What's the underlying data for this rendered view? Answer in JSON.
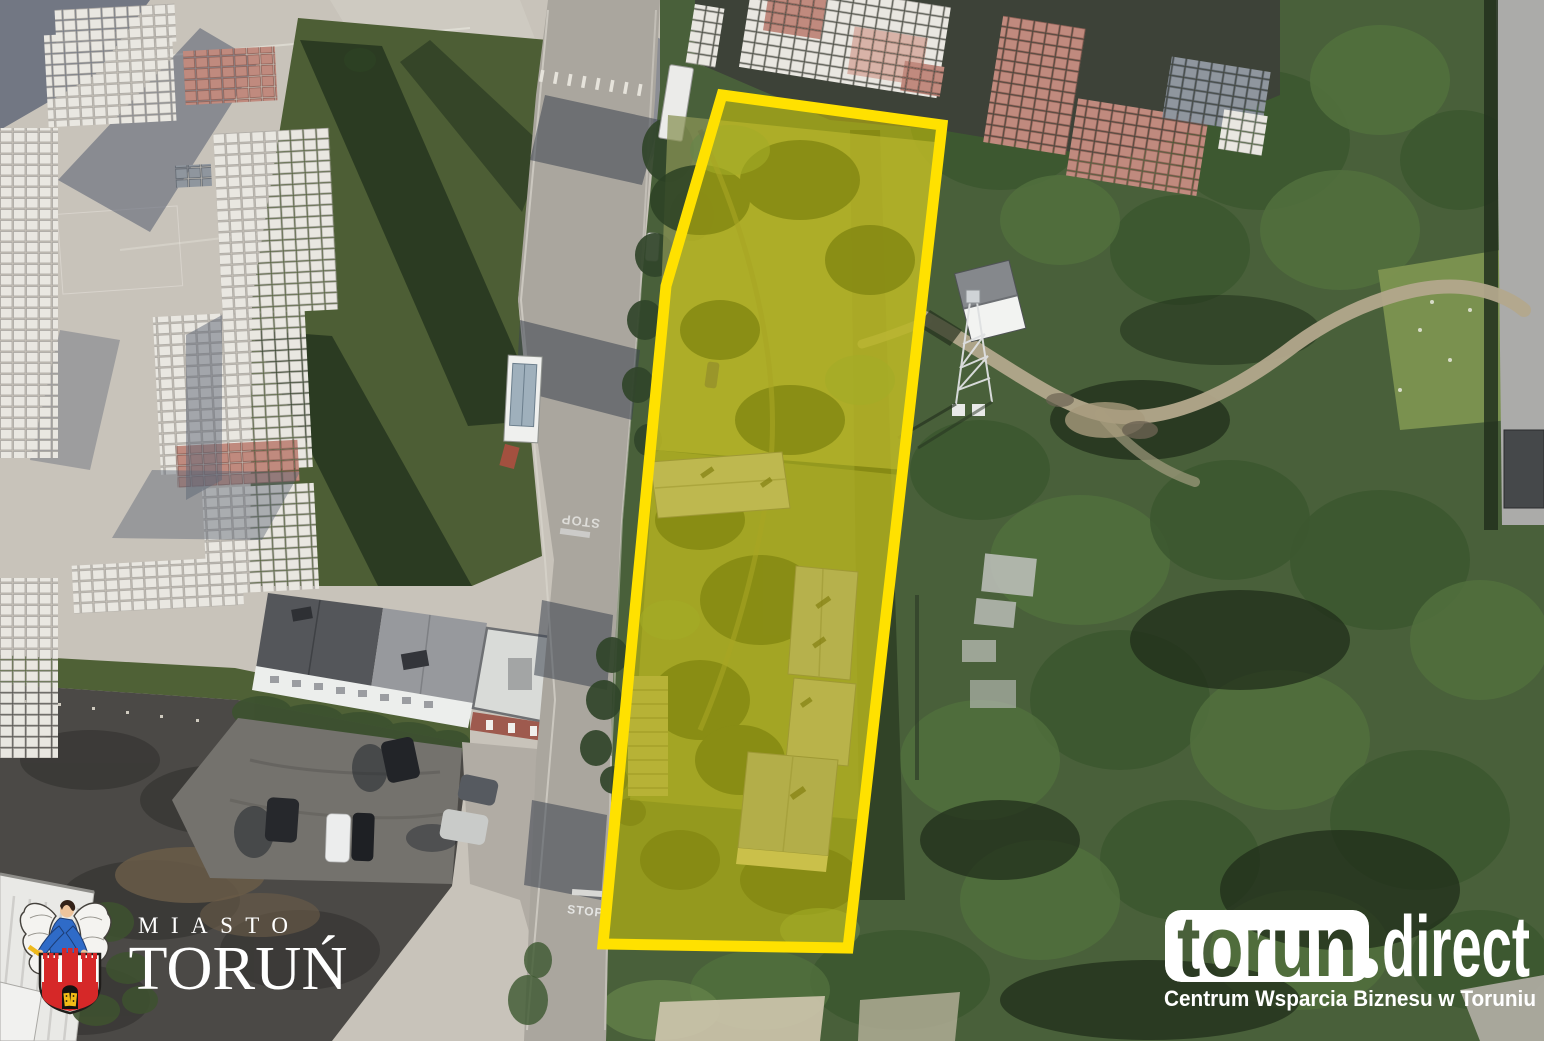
{
  "canvas": {
    "width": 1544,
    "height": 1041
  },
  "parcel_highlight": {
    "points": "722,95 942,125 848,948 603,944 666,286",
    "stroke_color": "#ffe100",
    "fill_color": "#e6d800"
  },
  "road_markings": {
    "stop_top": "STOP",
    "stop_bottom": "STOP"
  },
  "city_logo": {
    "line1": "MIASTO",
    "line2": "TORUŃ",
    "text_color": "#ffffff",
    "crest_colors": {
      "castle_red": "#d62828",
      "angel_blue": "#2f6bc8",
      "gold": "#eeb91c",
      "wing_white": "#f4f3f0"
    }
  },
  "direct_logo": {
    "brand_left": "torun",
    "brand_dot": ".",
    "brand_right": "direct",
    "tagline": "Centrum Wsparcia Biznesu w Toruniu",
    "color": "#ffffff"
  }
}
